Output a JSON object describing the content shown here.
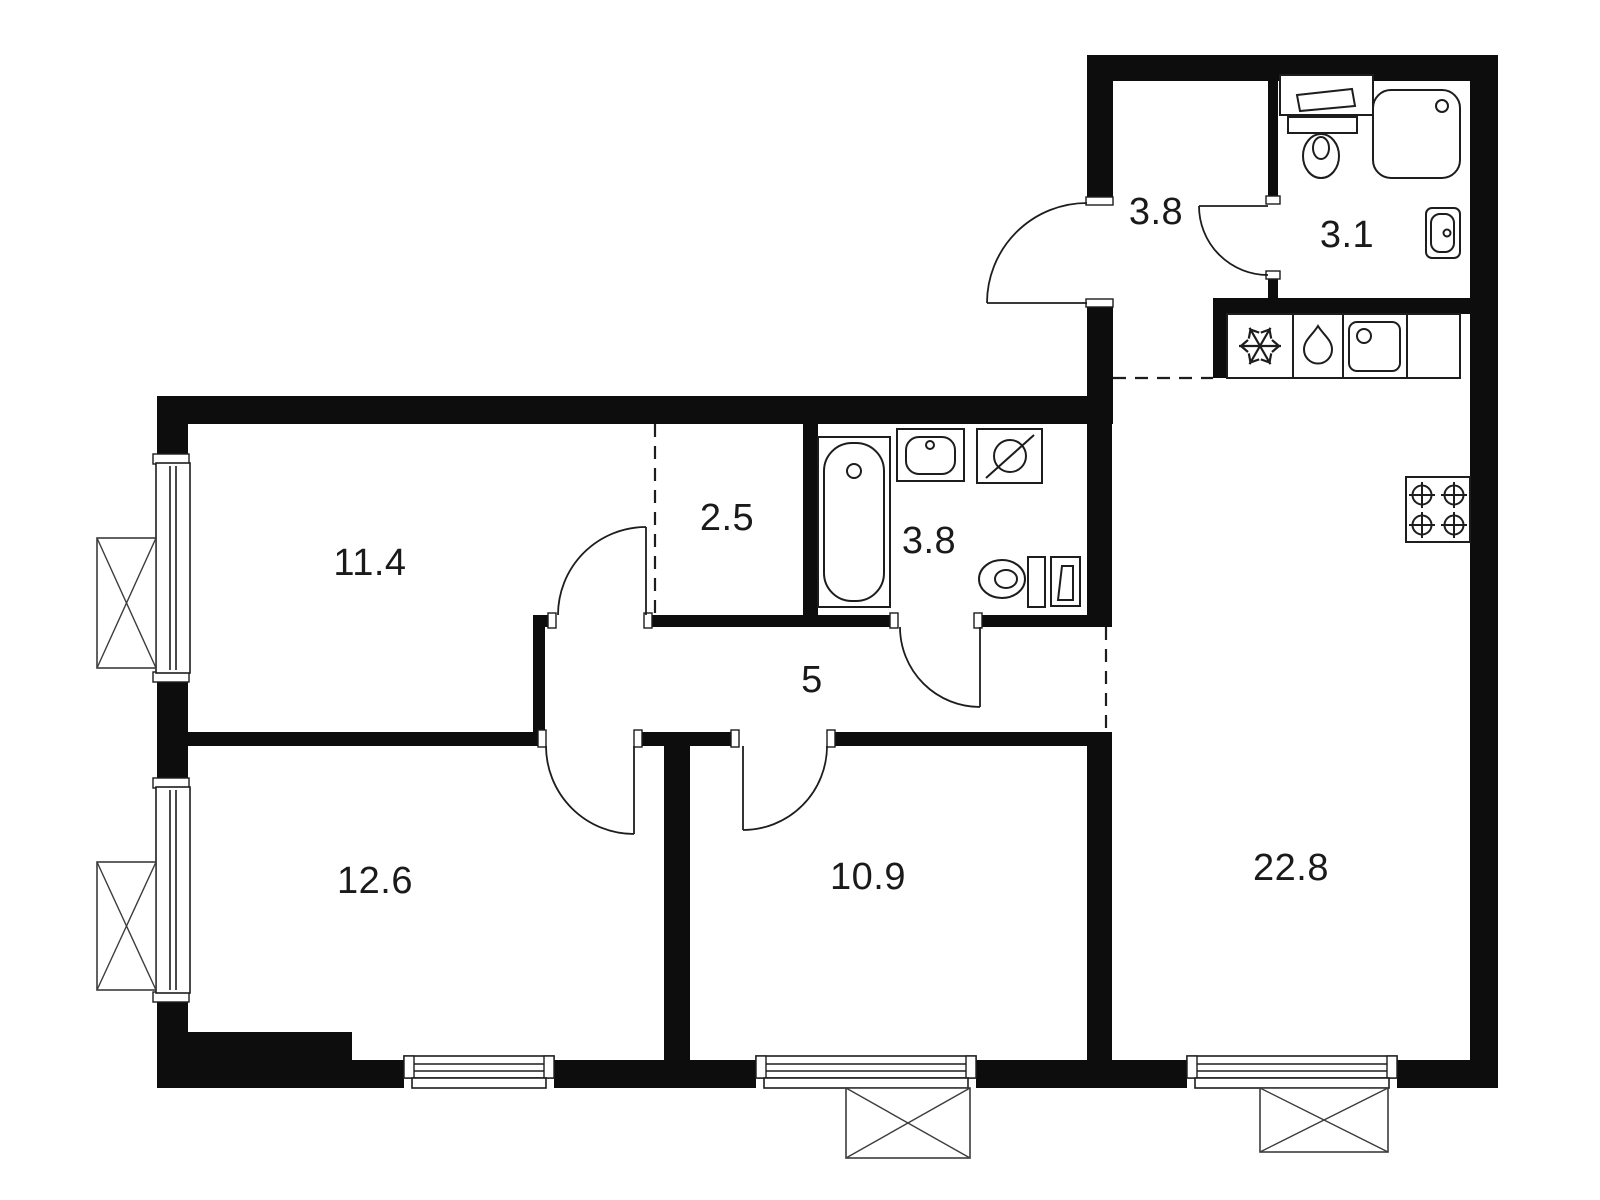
{
  "meta": {
    "background": "#ffffff",
    "wall_color": "#0d0d0d",
    "line_color": "#1d1d1d",
    "label_color": "#1a1a1a"
  },
  "rooms": {
    "hallway": {
      "area": "3.8"
    },
    "bathroom_top": {
      "area": "3.1"
    },
    "wardrobe": {
      "area": "2.5"
    },
    "bedroom_top": {
      "area": "11.4"
    },
    "bathroom_main": {
      "area": "3.8"
    },
    "corridor": {
      "area": "5"
    },
    "bedroom_bottom_left": {
      "area": "12.6"
    },
    "bedroom_bottom_mid": {
      "area": "10.9"
    },
    "living_kitchen": {
      "area": "22.8"
    }
  },
  "icons": {
    "kitchen": [
      "fridge-snowflake-icon",
      "dishwasher-drop-icon",
      "kitchen-sink-icon",
      "stove-burners-icon"
    ],
    "bathroom_top": [
      "washbasin-icon",
      "toilet-icon",
      "shower-icon",
      "washbasin-icon"
    ],
    "bathroom_main": [
      "bathtub-icon",
      "washbasin-icon",
      "washing-machine-icon",
      "toilet-icon",
      "boiler-cabinet-icon"
    ],
    "exterior": [
      "window-icon",
      "balcony-icon",
      "door-swing-icon"
    ]
  }
}
